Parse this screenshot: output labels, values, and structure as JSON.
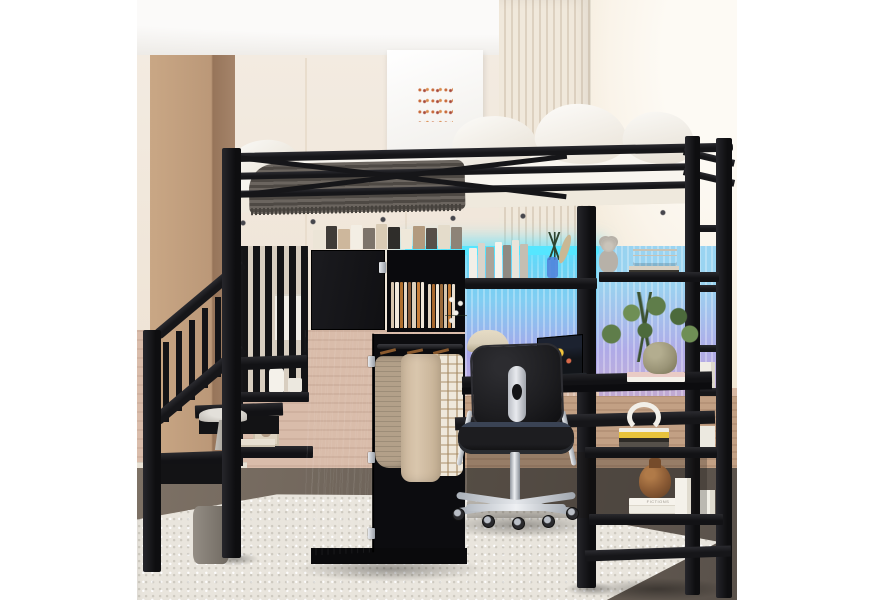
{
  "meta": {
    "alt": "Product photo of a black metal twin loft bed with storage staircase, built-in wardrobe with hanging clothes, LED-lit shelves, desk with office chair, lamp, laptop and plants, set in a beige room with ribbed wall panels, framed artwork, dark wood floor and a cream speckled rug",
    "domain": "furniture-product-photo"
  },
  "palette": {
    "frame": "#161619",
    "frame2": "#26262b",
    "wall": "#f3ebe1",
    "wall2": "#e9ddcd",
    "ceiling": "#f7f6f3",
    "pillar": "#c9a785",
    "pillar-dk": "#a5846a",
    "ribbed1": "#f0e8db",
    "ribbed2": "#ddd1c0",
    "rightwall": "#faf4ea",
    "wainscot": "#d9bcaa",
    "deskwall": "#c2a084",
    "floor1": "#7d7165",
    "floor2": "#59514a",
    "rug": "#e9e5dd",
    "mattress": "#f8f5ef",
    "blanket1": "#6b655f",
    "blanket2": "#4e4944",
    "led": "#55e6ff",
    "glow1": "#82cdf2",
    "glow2": "#a8a4e9",
    "chrome": "#cdd1d7",
    "wood-h": "#8a5a2e",
    "sweater": "#b3a089",
    "coat": "#d9c6ad",
    "plaid": "#efe8db",
    "plaidline": "#a4875f",
    "lamp": "#d9cfba",
    "vase-olive": "#9a9477",
    "vase-brown": "#8a5a34",
    "vase-blue": "#4f7fd9",
    "plant": "#5f7d4a",
    "chair": "#1d1d20",
    "radio-brown": "#7a4f33",
    "pink-book": "#e9cbc5",
    "yellow-book": "#e7c23b"
  },
  "decor": {
    "wardrobe_top_books": [
      "#ece5d7",
      "#3f3b37",
      "#cdb79c",
      "#f3eee4",
      "#7d746b",
      "#d9cbb5",
      "#2f2d2a",
      "#efe8da",
      "#b29a7e",
      "#564f49",
      "#e4dccb",
      "#8d8478"
    ],
    "desk_shelf_books": [
      "#f2efe8",
      "#d9d4cb",
      "#aaa49a",
      "#f6f3ec",
      "#8f8a82",
      "#e8e4da",
      "#c4beb2"
    ],
    "cubby_stack_a": [
      "#d8c7b0",
      "#f1e9dc",
      "#b0702f",
      "#e6d9c8",
      "#8a5a36",
      "#ddd0bd",
      "#c9803d",
      "#efe6d8"
    ],
    "cubby_stack_b": [
      "#e2d5c2",
      "#a8682e",
      "#f0e8da",
      "#9a6a3a",
      "#d5c6b0",
      "#c07a36",
      "#e9dfd0"
    ],
    "white_book_label": "FICTIONS"
  },
  "scene": {
    "objects": [
      "loft-bed-frame",
      "guard-rails",
      "mattress",
      "pillows",
      "striped-blanket",
      "storage-staircase",
      "stair-railing",
      "wardrobe",
      "hanging-clothes",
      "folded-textiles",
      "desk",
      "office-chair",
      "desk-lamp",
      "laptop",
      "potted-plants",
      "led-light-strip",
      "bookshelves",
      "headphones",
      "retro-radio",
      "teddy-bear",
      "pedestal-bowl",
      "photo-frame",
      "brown-vase",
      "white-books",
      "framed-wall-art",
      "wood-pillar",
      "ribbed-wall-panel",
      "area-rug"
    ]
  }
}
